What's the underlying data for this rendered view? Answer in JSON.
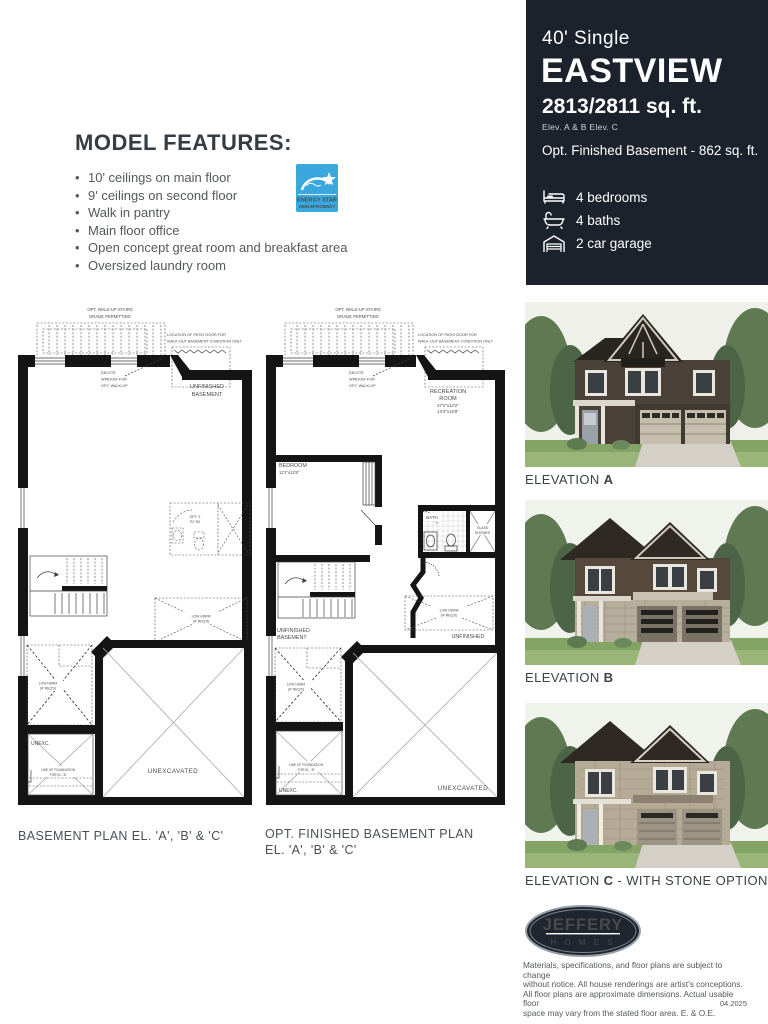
{
  "features": {
    "heading": "MODEL FEATURES:",
    "items": [
      "10' ceilings on main floor",
      "9' ceilings on second floor",
      "Walk in pantry",
      "Main floor office",
      "Open concept great room and breakfast area",
      "Oversized laundry room"
    ],
    "energy_star": {
      "line1": "ENERGY STAR",
      "line2": "HIGH EFFICIENCY"
    }
  },
  "plans": {
    "shared": {
      "walkup_1": "OPT. WALK-UP STAIRS",
      "walkup_2": "GRADE PERMITTING",
      "patio_1": "LOCATION OF PATIO DOOR FOR",
      "patio_2": "WALK-OUT BASEMENT CONDITION ONLY",
      "delete_1": "DELETE",
      "delete_2": "WINDOW FOR",
      "delete_3": "OPT. WALK-UP",
      "low_hdrm_1": "LOW HDRM",
      "low_hdrm_2": "(IF REQ'D)",
      "unexc_short": "UNEXC.",
      "unexcavated": "UNEXCAVATED",
      "foundation_1": "LINE OF FOUNDATION",
      "foundation_2": "FOR EL. 'B'"
    },
    "left": {
      "room_1": "UNFINISHED",
      "room_2": "BASEMENT",
      "opt3pc_1": "OPT. 3",
      "opt3pc_2": "PC R/I",
      "caption": "BASEMENT PLAN EL. 'A', 'B' & 'C'"
    },
    "right": {
      "rec_1": "RECREATION",
      "rec_2": "ROOM",
      "rec_3": "27'2\"x12'2\"",
      "rec_4": "13'4\"x16'8\"",
      "bedroom_1": "BEDROOM",
      "bedroom_2": "11'2\"x12'6\"",
      "bath": "BATH",
      "shower_1": "GLASS",
      "shower_2": "SHOWER",
      "unf_1": "UNFINISHED",
      "unf_2": "BASEMENT",
      "unfinished": "UNFINISHED",
      "caption_1": "OPT. FINISHED BASEMENT PLAN",
      "caption_2": "EL. 'A', 'B' & 'C'"
    }
  },
  "sidebar": {
    "type_label": "40' Single",
    "model_name": "EASTVIEW",
    "sqft": "2813/2811 sq. ft.",
    "elev_note": "Elev. A & B   Elev. C",
    "basement_note": "Opt. Finished Basement - 862 sq. ft.",
    "specs": [
      {
        "icon": "bed-icon",
        "label": "4 bedrooms"
      },
      {
        "icon": "bath-icon",
        "label": "4 baths"
      },
      {
        "icon": "garage-icon",
        "label": "2 car garage"
      }
    ],
    "elevations": [
      {
        "prefix": "ELEVATION ",
        "letter": "A",
        "suffix": ""
      },
      {
        "prefix": "ELEVATION ",
        "letter": "B",
        "suffix": ""
      },
      {
        "prefix": "ELEVATION ",
        "letter": "C",
        "suffix": " - WITH STONE OPTION"
      }
    ],
    "logo": {
      "name": "JEFFERY",
      "sub": "H  O  M  E  S"
    },
    "disclaimer": [
      "Materials, specifications, and floor plans are subject to change",
      "without notice. All house renderings are artist's conceptions.",
      "All floor plans are approximate dimensions. Actual usable floor",
      "space may vary from the stated floor area. E. & O.E."
    ],
    "date_code": "04.2025"
  }
}
